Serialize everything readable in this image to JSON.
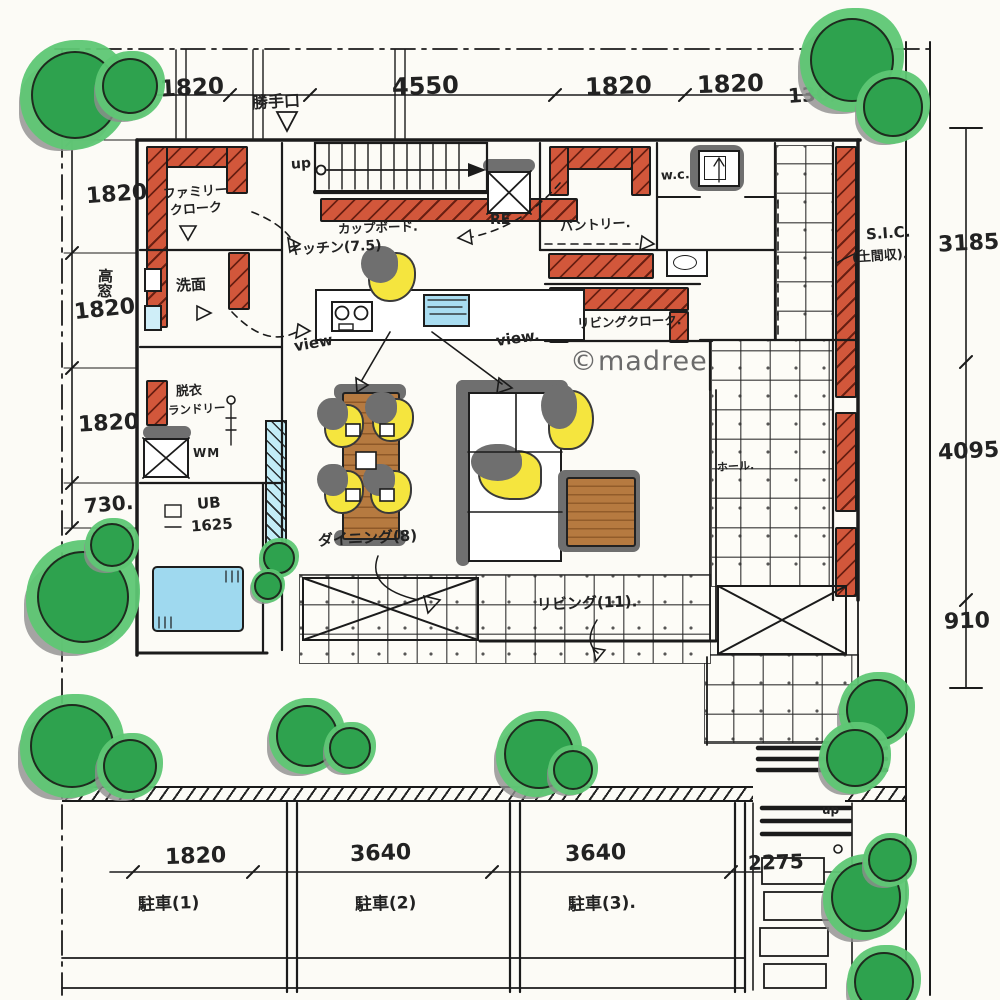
{
  "watermark": "©madree",
  "dimensions": {
    "top": [
      "1820",
      "4550",
      "1820",
      "1820",
      "1365"
    ],
    "left": [
      "1820",
      "1820",
      "1820",
      "730."
    ],
    "right": [
      "3185",
      "4095",
      "910"
    ],
    "bottom": [
      "1820",
      "3640",
      "3640",
      "2275"
    ]
  },
  "labels": {
    "back_door": "勝手口",
    "stairs_up": "up",
    "cupboard": "カップボード.",
    "kitchen": "キッチン(7.5)",
    "fridge": "RE",
    "pantry": "パントリー.",
    "wc": "w.c.",
    "family_closet_1": "ファミリー",
    "family_closet_2": "クローク",
    "washroom": "洗面",
    "high_window": "高窓",
    "undress_1": "脱衣",
    "undress_2": "ランドリー",
    "washing_machine": "WM",
    "unit_bath_1": "UB",
    "unit_bath_2": "1625",
    "living_closet": "リビングクローク.",
    "shoe_closet_1": "S.I.C.",
    "shoe_closet_2": "(土間収).",
    "dining": "ダイニング(8)",
    "living": "リビング(11).",
    "hall": "ホール.",
    "view_left": "view",
    "view_right": "view.",
    "entry_up": "up",
    "parking_1": "駐車(1)",
    "parking_2": "駐車(2)",
    "parking_3": "駐車(3)."
  }
}
